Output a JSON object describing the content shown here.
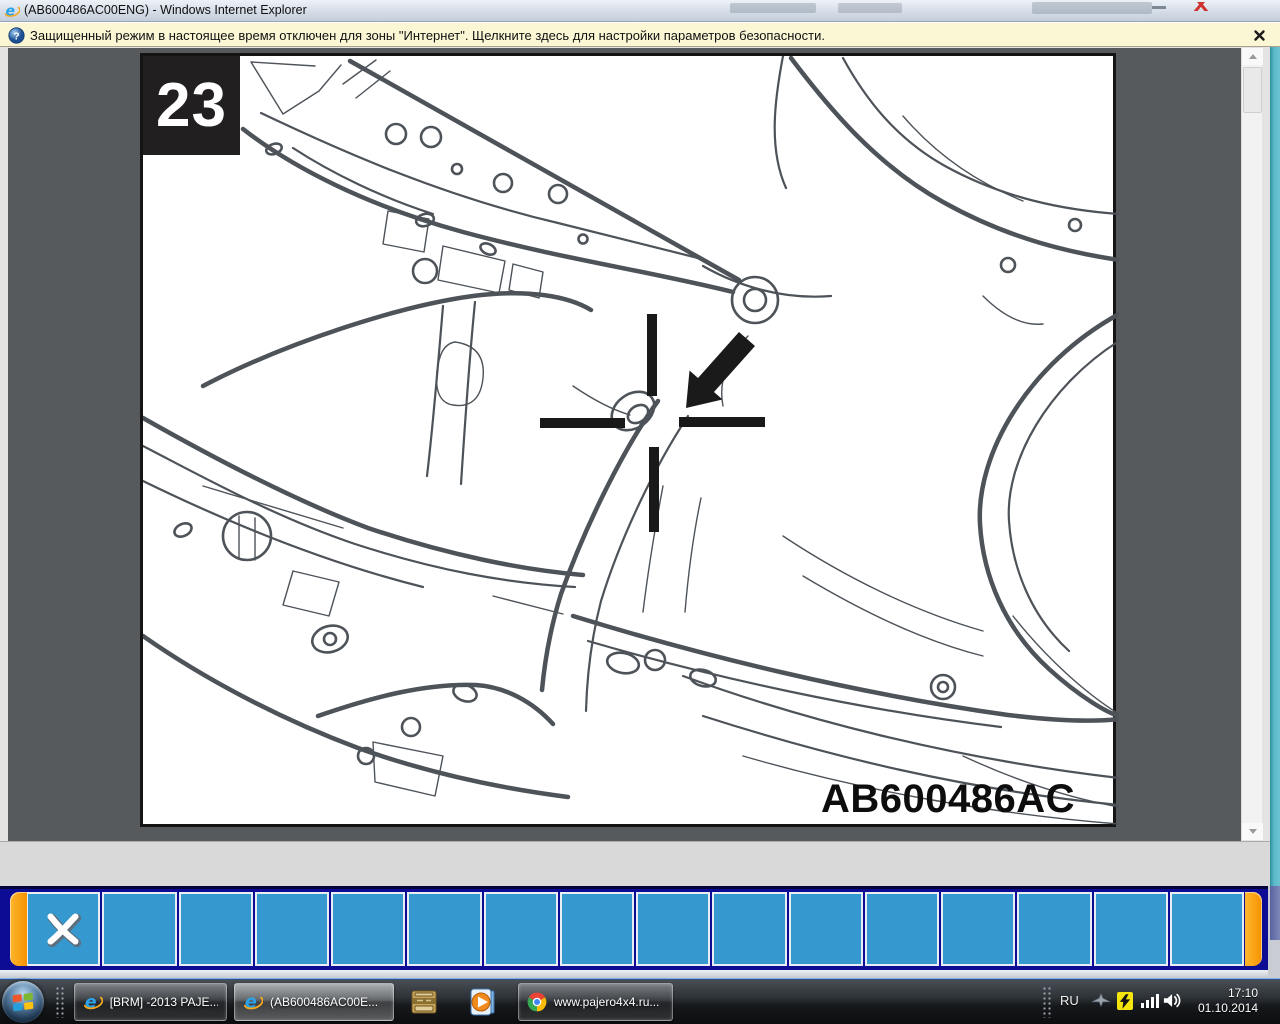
{
  "window": {
    "title": "(AB600486AC00ENG) - Windows Internet Explorer"
  },
  "infobar": {
    "message": "Защищенный режим в настоящее время отключен для зоны \"Интернет\".  Щелкните здесь для настройки параметров безопасности."
  },
  "document": {
    "figure_number": "23",
    "figure_code": "AB600486AC"
  },
  "toolbar": {
    "button_count": 16,
    "first_button_icon": "x-cut-icon"
  },
  "taskbar": {
    "buttons": [
      {
        "label": "[BRM] -2013 PAJE...",
        "icon": "internet-explorer"
      },
      {
        "label": "(AB600486AC00E...",
        "icon": "internet-explorer",
        "active": true
      },
      {
        "label": "www.pajero4x4.ru...",
        "icon": "chrome"
      }
    ],
    "pinned_icons": [
      "parts-catalog",
      "windows-media-player"
    ],
    "tray": {
      "language": "RU",
      "time": "17:10",
      "date": "01.10.2014"
    }
  },
  "colors": {
    "toolbar_navy": "#0c0c94",
    "toolbar_button_blue": "#3598ce",
    "toolbar_cap_orange": "#f59300",
    "infobar_cream": "#fbf7d5",
    "viewport_gray": "#565a5d",
    "teal_edge": "#5cb9c8"
  }
}
